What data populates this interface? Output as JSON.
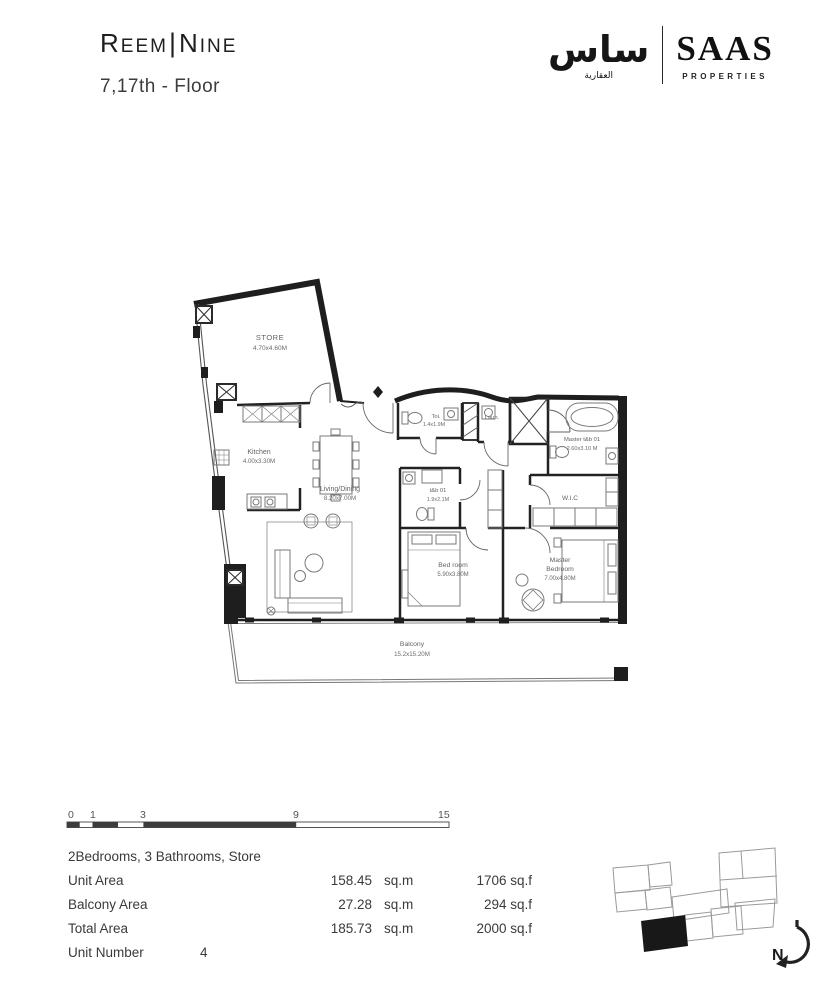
{
  "header": {
    "brand": {
      "word1_initial": "R",
      "word1_rest": "EEM",
      "divider": "|",
      "word2_initial": "N",
      "word2_rest": "INE"
    },
    "floor_label": "7,17th - Floor"
  },
  "brand_right": {
    "arabic_main": "ساس",
    "arabic_sub": "العقارية",
    "latin_main": "SAAS",
    "latin_sub": "PROPERTIES"
  },
  "plan": {
    "rooms": {
      "store": {
        "name": "STORE",
        "dims": "4.70x4.60M"
      },
      "kitchen": {
        "name": "Kitchen",
        "dims": "4.00x3.30M"
      },
      "living": {
        "name": "Living/Dining",
        "dims": "8.20x7.00M"
      },
      "toilet": {
        "name": "Toi.",
        "dims": "1.4x1.9M"
      },
      "laundry": {
        "name": "Laun."
      },
      "master_bath": {
        "name": "Master t&b 01",
        "dims": "2.60x3.10 M"
      },
      "wic": {
        "name": "W.I.C"
      },
      "bath2": {
        "name": "t&b 01",
        "dims": "1.9x2.1M"
      },
      "bedroom": {
        "name": "Bed room",
        "dims": "5.90x3.80M"
      },
      "master_bedroom": {
        "line1": "Master",
        "line2": "Bedroom",
        "dims": "7.00x4.80M"
      },
      "balcony": {
        "name": "Balcony",
        "dims": "15.2x15.20M"
      }
    }
  },
  "scale_bar": {
    "labels": [
      "0",
      "1",
      "3",
      "9",
      "15"
    ]
  },
  "summary": {
    "config": "2Bedrooms, 3 Bathrooms, Store",
    "rows": [
      {
        "label": "Unit Area",
        "sqm": "158.45",
        "sqm_unit": "sq.m",
        "sqf": "1706 sq.f"
      },
      {
        "label": "Balcony Area",
        "sqm": "27.28",
        "sqm_unit": "sq.m",
        "sqf": "294 sq.f"
      },
      {
        "label": "Total Area",
        "sqm": "185.73",
        "sqm_unit": "sq.m",
        "sqf": "2000 sq.f"
      }
    ],
    "unit_number_label": "Unit Number",
    "unit_number": "4"
  },
  "compass": {
    "north": "N"
  }
}
